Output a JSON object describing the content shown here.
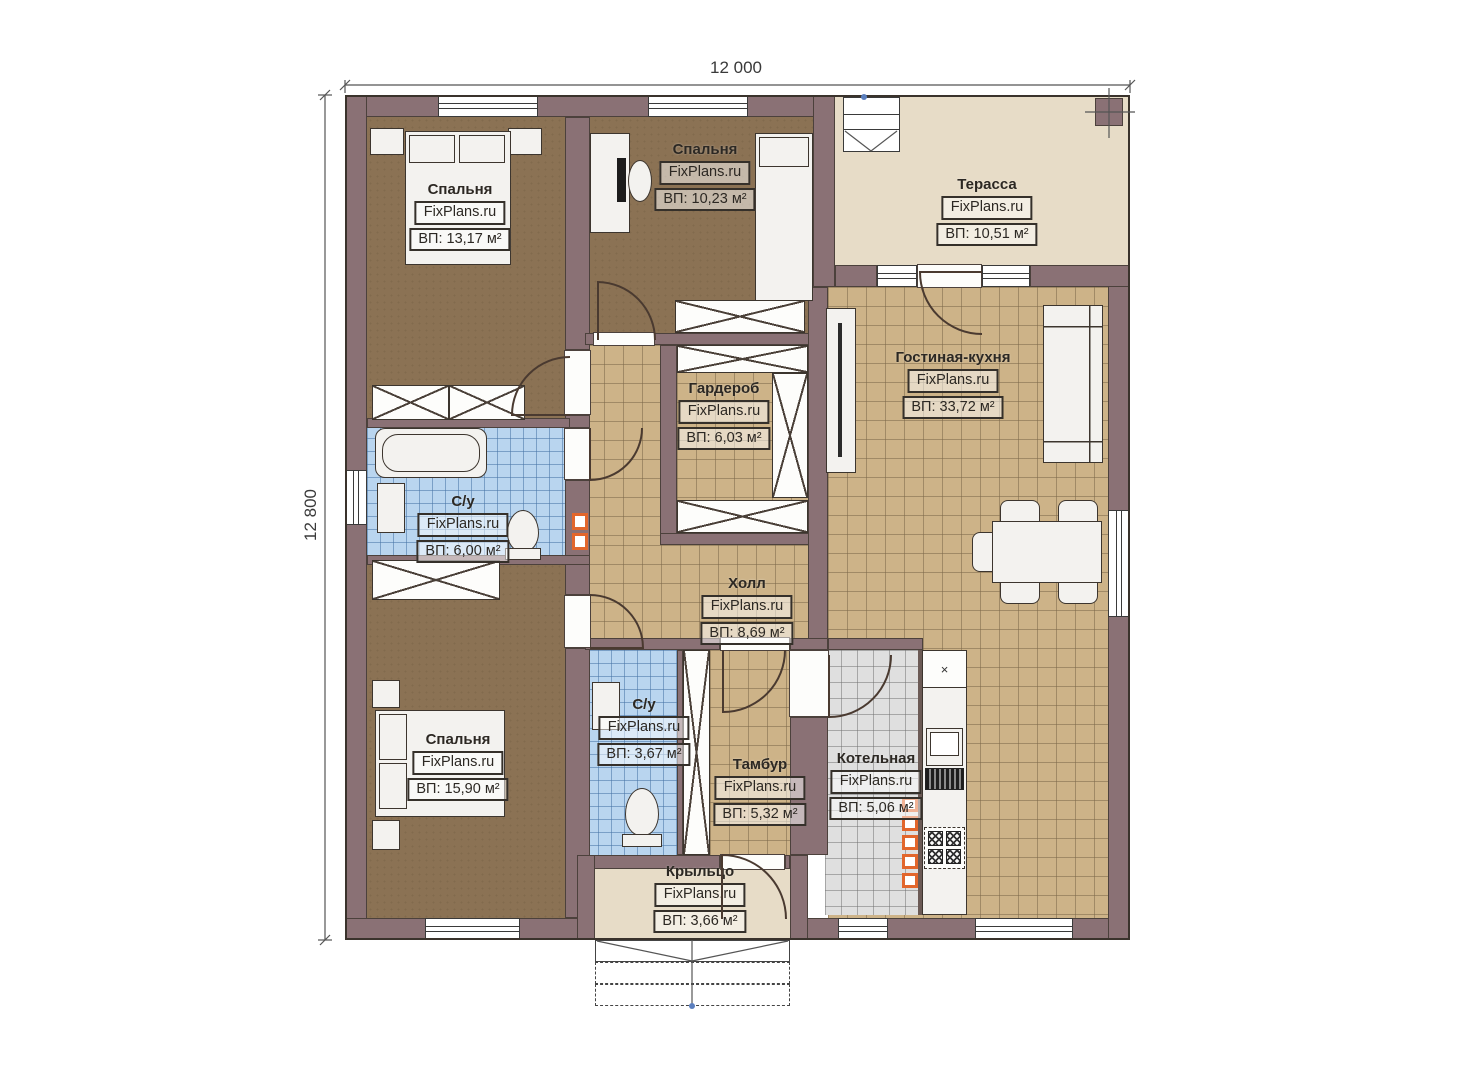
{
  "title": "Floor plan — one storey house",
  "dimensions": {
    "width_label": "12 000",
    "height_label": "12 800"
  },
  "watermark": "FixPlans.ru",
  "rooms": [
    {
      "id": "bedroom-1",
      "name": "Спальня",
      "watermark": "FixPlans.ru",
      "area": "ВП: 13,17 м²"
    },
    {
      "id": "bedroom-2",
      "name": "Спальня",
      "watermark": "FixPlans.ru",
      "area": "ВП: 10,23 м²"
    },
    {
      "id": "terrace",
      "name": "Терасса",
      "watermark": "FixPlans.ru",
      "area": "ВП: 10,51 м²"
    },
    {
      "id": "living-kitchen",
      "name": "Гостиная-кухня",
      "watermark": "FixPlans.ru",
      "area": "ВП: 33,72 м²"
    },
    {
      "id": "wardrobe",
      "name": "Гардероб",
      "watermark": "FixPlans.ru",
      "area": "ВП: 6,03 м²"
    },
    {
      "id": "bathroom-1",
      "name": "С/у",
      "watermark": "FixPlans.ru",
      "area": "ВП: 6,00 м²"
    },
    {
      "id": "hall",
      "name": "Холл",
      "watermark": "FixPlans.ru",
      "area": "ВП: 8,69 м²"
    },
    {
      "id": "bedroom-3",
      "name": "Спальня",
      "watermark": "FixPlans.ru",
      "area": "ВП: 15,90 м²"
    },
    {
      "id": "bathroom-2",
      "name": "С/у",
      "watermark": "FixPlans.ru",
      "area": "ВП: 3,67 м²"
    },
    {
      "id": "tambour",
      "name": "Тамбур",
      "watermark": "FixPlans.ru",
      "area": "ВП: 5,32 м²"
    },
    {
      "id": "boiler-room",
      "name": "Котельная",
      "watermark": "FixPlans.ru",
      "area": "ВП: 5,06 м²"
    },
    {
      "id": "porch",
      "name": "Крыльцо",
      "watermark": "FixPlans.ru",
      "area": "ВП: 3,66 м²"
    }
  ],
  "colors": {
    "wall": "#8a7175",
    "bedroom_floor": "#8b7254",
    "tile_floor": "#cdb388",
    "terrace_floor": "#e7dcc7",
    "bathroom_floor": "#b9d5ef",
    "boiler_floor": "#dfdfdf",
    "accent_orange": "#e2662c"
  }
}
